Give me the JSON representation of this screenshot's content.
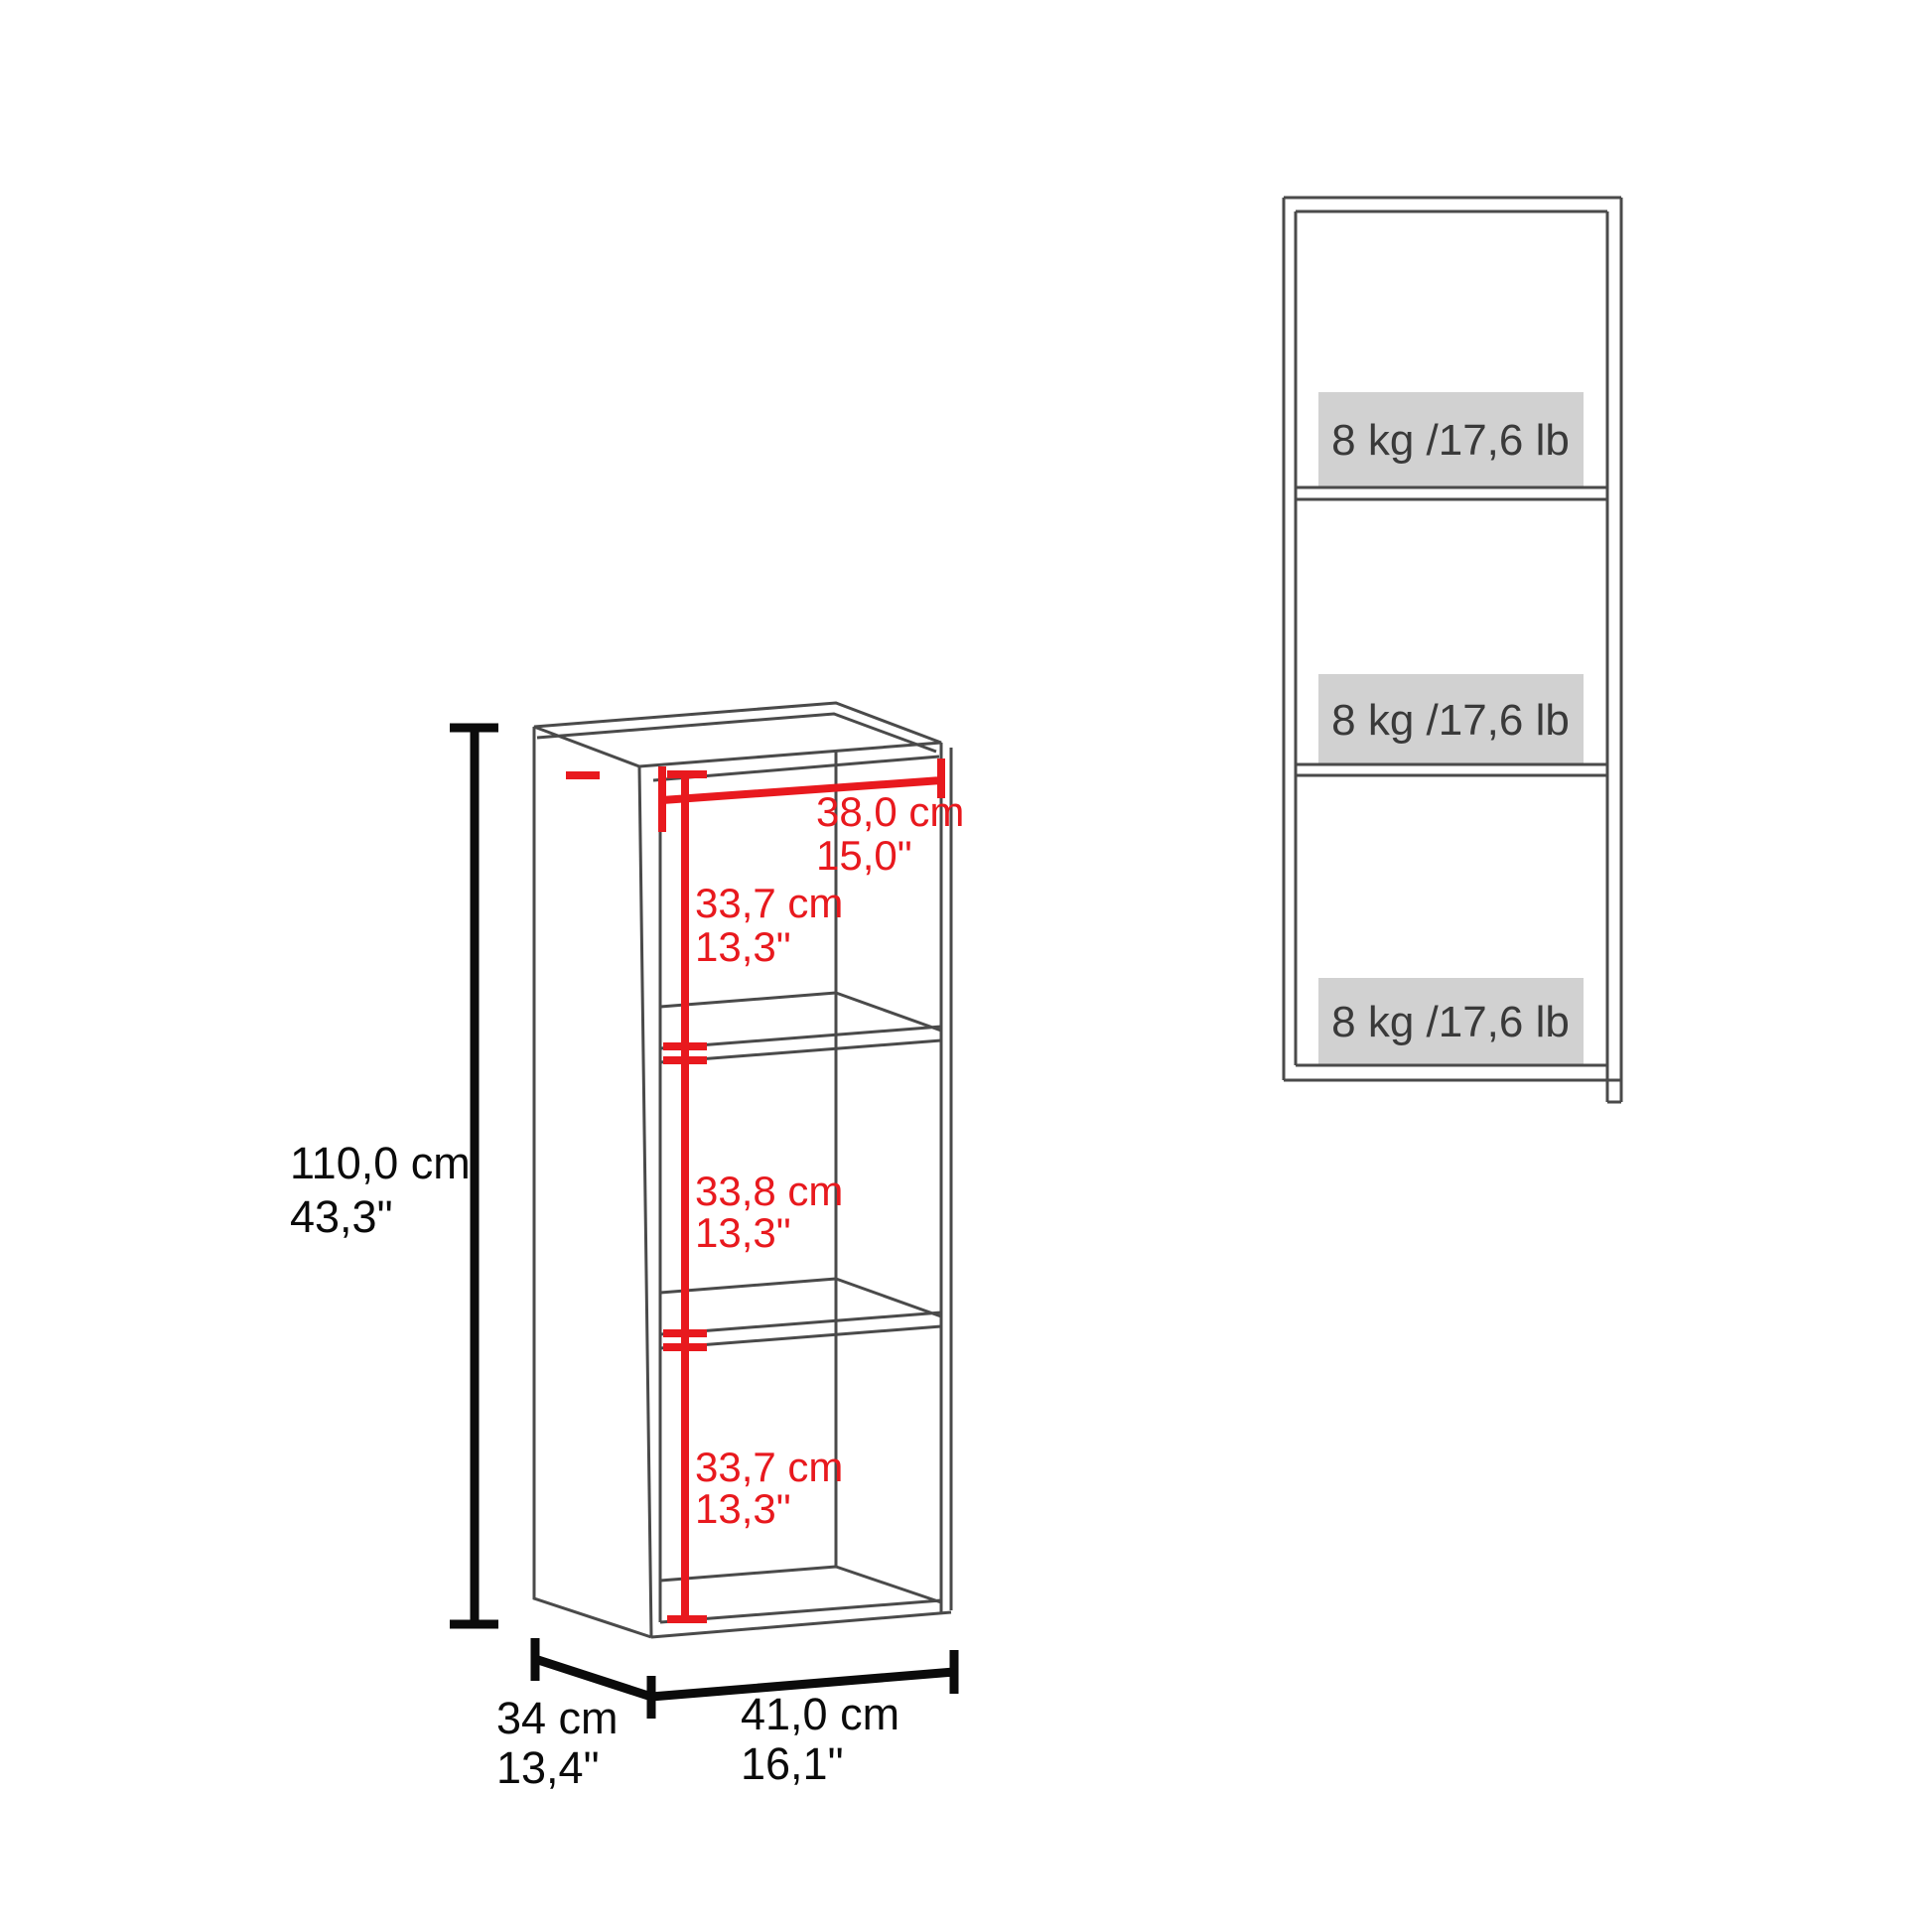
{
  "colors": {
    "background": "#ffffff",
    "accent_red": "#e8191e",
    "dimension_black": "#0b0b0b",
    "drawing_gray": "#4a4a4a",
    "capacity_box_gray": "#d1d1d1",
    "capacity_text_gray": "#3a3a3a"
  },
  "left_view": {
    "height": {
      "cm": "110,0 cm",
      "in": "43,3\""
    },
    "inner_width": {
      "cm": "38,0 cm",
      "in": "15,0\""
    },
    "compartments": [
      {
        "cm": "33,7 cm",
        "in": "13,3\""
      },
      {
        "cm": "33,8 cm",
        "in": "13,3\""
      },
      {
        "cm": "33,7 cm",
        "in": "13,3\""
      }
    ],
    "depth": {
      "cm": "34 cm",
      "in": "13,4\""
    },
    "width": {
      "cm": "41,0 cm",
      "in": "16,1\""
    }
  },
  "front_view": {
    "shelves": [
      {
        "capacity": "8 kg /17,6 lb"
      },
      {
        "capacity": "8 kg /17,6 lb"
      },
      {
        "capacity": "8 kg /17,6 lb"
      }
    ]
  }
}
